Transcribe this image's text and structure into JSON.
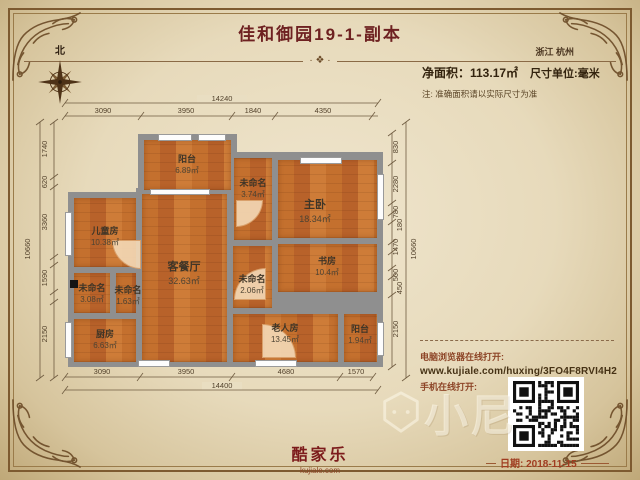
{
  "header": {
    "title": "佳和御园19-1-副本",
    "region": "浙江 杭州",
    "area_label": "净面积：113.17㎡",
    "unit_label": "尺寸单位:毫米",
    "note": "注: 准确面积请以实际尺寸为准",
    "north_label": "北",
    "ornament": "· ❖ ·"
  },
  "dimensions": {
    "top": {
      "total": "14240",
      "segments": [
        "3090",
        "3950",
        "1840",
        "4350"
      ]
    },
    "bottom": {
      "total": "14400",
      "segments": [
        "3090",
        "3950",
        "4680",
        "1570"
      ]
    },
    "left": {
      "total": "10660",
      "segments": [
        "1740",
        "620",
        "3360",
        "1590",
        "2150"
      ]
    },
    "right": {
      "total": "10660",
      "segments": [
        "830",
        "2280",
        "780",
        "180",
        "1470",
        "500",
        "450",
        "2150"
      ]
    }
  },
  "plan": {
    "rooms": [
      {
        "id": "balcony-top",
        "name": "阳台",
        "area": "6.89㎡"
      },
      {
        "id": "hall-top",
        "name": "未命名",
        "area": "3.74㎡"
      },
      {
        "id": "master-bedroom",
        "name": "主卧",
        "area": "18.34㎡"
      },
      {
        "id": "children-room",
        "name": "儿童房",
        "area": "10.38㎡"
      },
      {
        "id": "living-dining",
        "name": "客餐厅",
        "area": "32.63㎡"
      },
      {
        "id": "hall-mid",
        "name": "未命名",
        "area": "2.06㎡"
      },
      {
        "id": "study",
        "name": "书房",
        "area": "10.4㎡"
      },
      {
        "id": "hall-left-a",
        "name": "未命名",
        "area": "3.08㎡"
      },
      {
        "id": "hall-left-b",
        "name": "未命名",
        "area": "1.63㎡"
      },
      {
        "id": "kitchen",
        "name": "厨房",
        "area": "6.63㎡"
      },
      {
        "id": "elder-room",
        "name": "老人房",
        "area": "13.45㎡"
      },
      {
        "id": "balcony-right",
        "name": "阳台",
        "area": "1.94㎡"
      }
    ]
  },
  "footer": {
    "desktop_label": "电脑浏览器在线打开:",
    "url": "www.kujiale.com/huxing/3FO4F8RVI4H2",
    "mobile_label": "手机在线打开:",
    "date_label": "日期: 2018-11-15",
    "brand": "酷家乐",
    "brand_url": "kujiale.com",
    "watermark": "小尼"
  },
  "colors": {
    "accent_maroon": "#6e2121",
    "floor_orange": "#c4702e",
    "wall_gray": "#8f8f8f",
    "parchment": "#e7dabb",
    "frame_brown": "#7d5a30"
  }
}
